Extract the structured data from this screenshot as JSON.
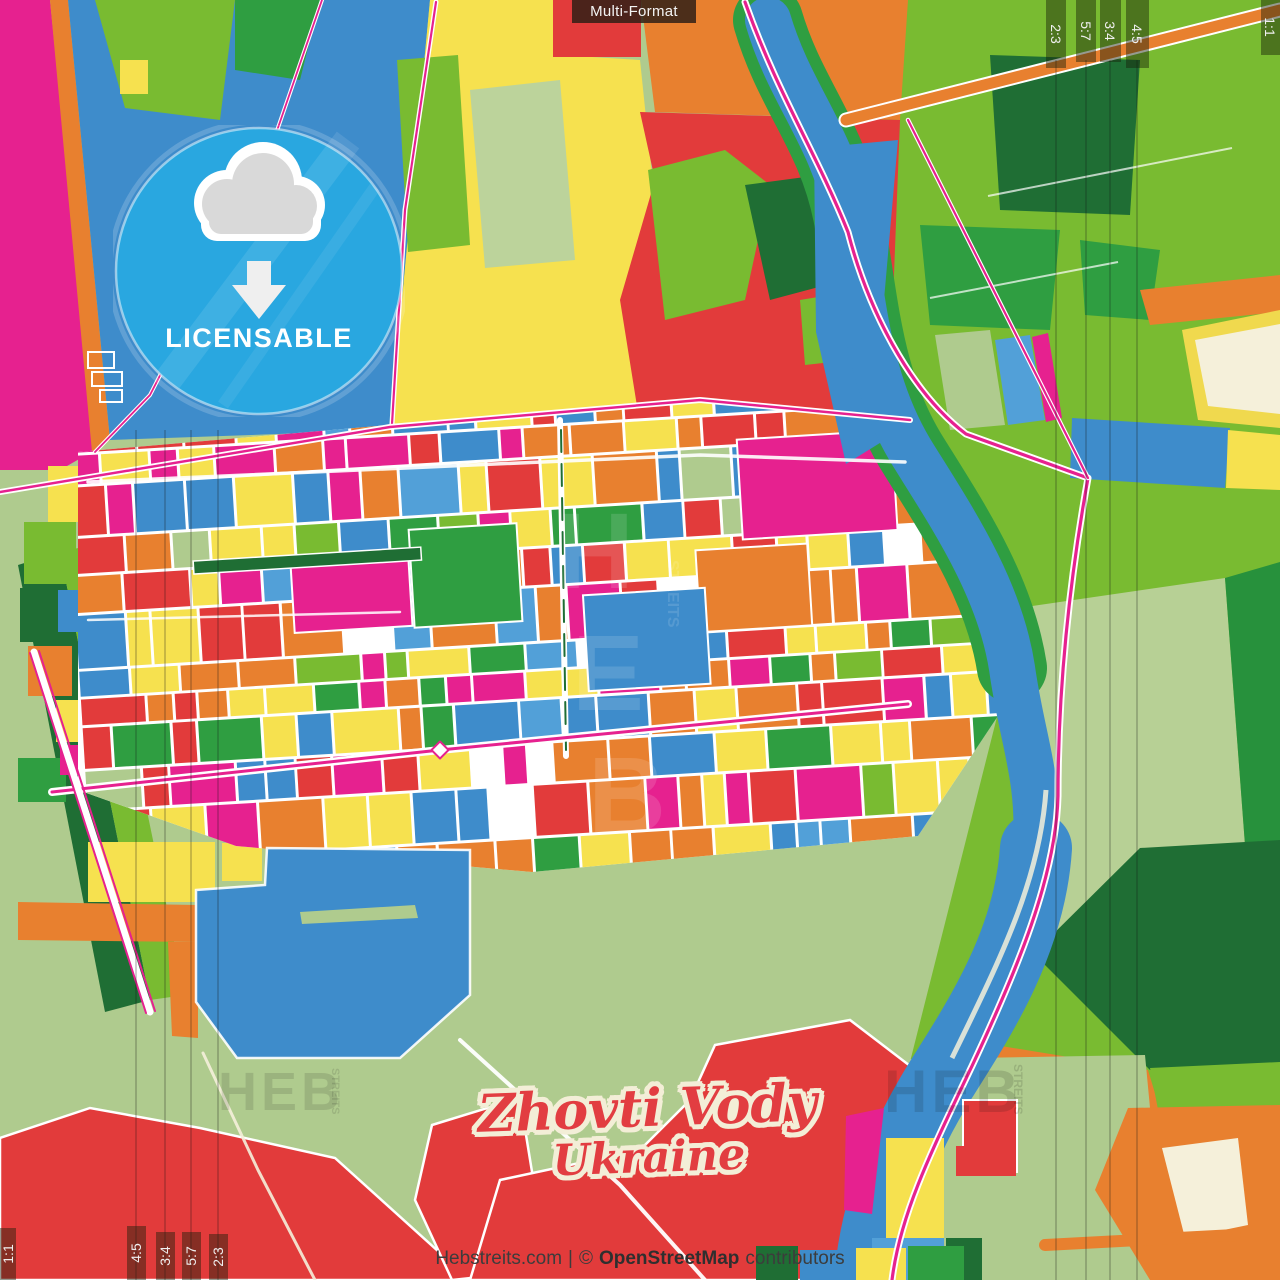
{
  "top_bar": {
    "label": "Multi-Format"
  },
  "badge": {
    "label": "LICENSABLE"
  },
  "title": {
    "city": "Zhovti Vody",
    "country": "Ukraine"
  },
  "footer": {
    "site": "Hebstreits.com",
    "divider": "|",
    "copyright": "©",
    "attribution": "OpenStreetMap",
    "suffix": "contributors"
  },
  "format_markers": {
    "top": [
      "2:3",
      "5:7",
      "3:4",
      "4:5"
    ],
    "top_corner": "1:1",
    "bottom": [
      "4:5",
      "3:4",
      "5:7",
      "2:3"
    ],
    "bottom_corner": "1:1"
  },
  "watermark": {
    "text": "HEB",
    "subtext": "STREITS"
  },
  "map_palette": {
    "blue": "#3e8ccb",
    "light_blue": "#52a0d8",
    "orange": "#e8802f",
    "red": "#e23b3b",
    "magenta": "#e6218f",
    "yellow": "#f6e14f",
    "green": "#2f9e41",
    "bright_green": "#79bb31",
    "dark_green": "#1f6e34",
    "sage": "#afcb8e",
    "cream": "#f5f0da",
    "badge_blue": "#29a7e0",
    "title_red": "#e23d41",
    "title_outline": "#f3eed7"
  }
}
